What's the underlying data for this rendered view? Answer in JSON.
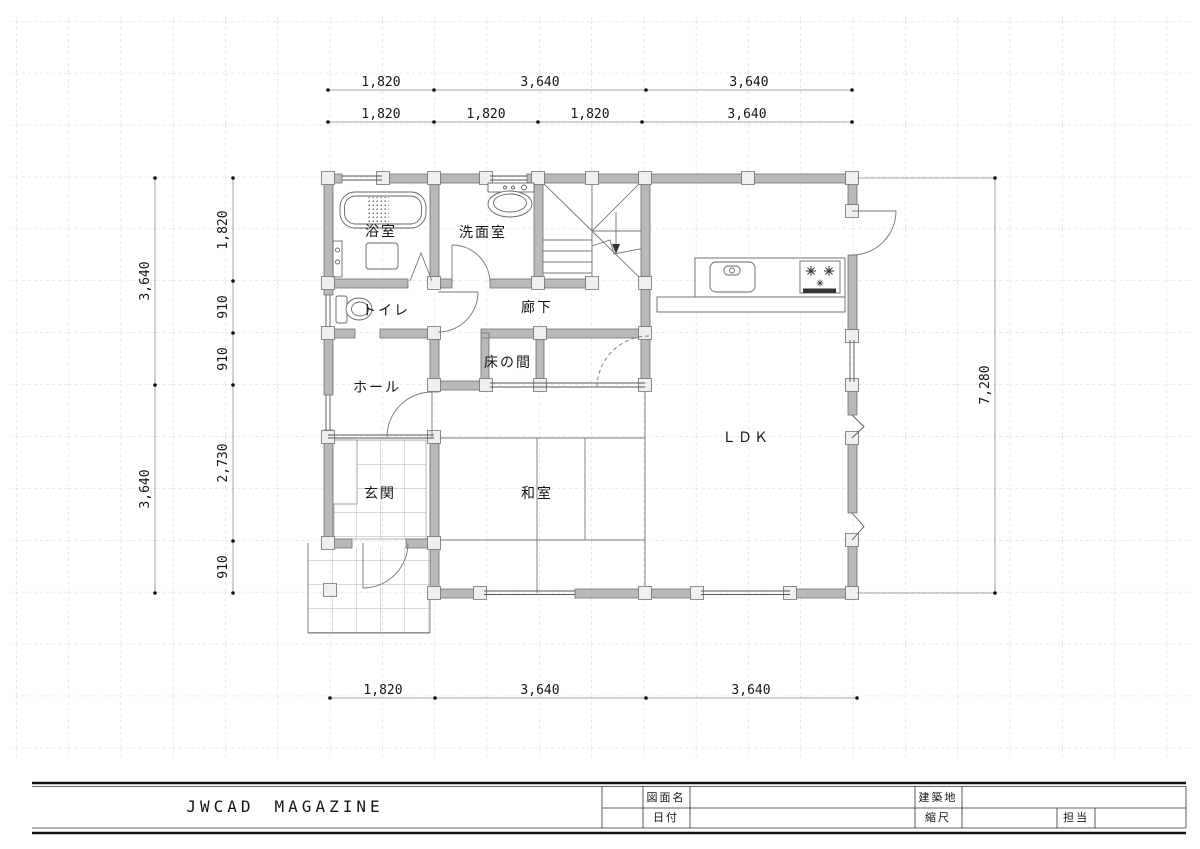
{
  "drawing": {
    "type": "floor-plan",
    "rooms": {
      "bath": "浴室",
      "washroom": "洗面室",
      "toilet": "トイレ",
      "corridor": "廊下",
      "tokonoma": "床の間",
      "hall": "ホール",
      "entrance": "玄関",
      "japanese_room": "和室",
      "ldk": "ＬＤＫ"
    },
    "dimensions": {
      "top_row1": [
        "1,820",
        "3,640",
        "3,640"
      ],
      "top_row2": [
        "1,820",
        "1,820",
        "1,820",
        "3,640"
      ],
      "bottom": [
        "1,820",
        "3,640",
        "3,640"
      ],
      "left_outer": [
        "3,640",
        "3,640"
      ],
      "left_inner": [
        "1,820",
        "910",
        "910",
        "2,730",
        "910"
      ],
      "right": [
        "7,280"
      ]
    }
  },
  "title_block": {
    "publisher": "JWCAD　MAGAZINE",
    "fields": {
      "drawing_name_label": "図面名",
      "drawing_name_value": "",
      "building_site_label": "建築地",
      "building_site_value": "",
      "date_label": "日付",
      "date_value": "",
      "scale_label": "縮尺",
      "scale_value": "",
      "staff_label": "担当",
      "staff_value": ""
    }
  },
  "colors": {
    "wall_fill": "#b9b9b9",
    "post_fill": "#efefef",
    "line": "#555555",
    "grid": "#c6c6c6",
    "dim_line": "#8a8a8a",
    "text": "#151515"
  }
}
